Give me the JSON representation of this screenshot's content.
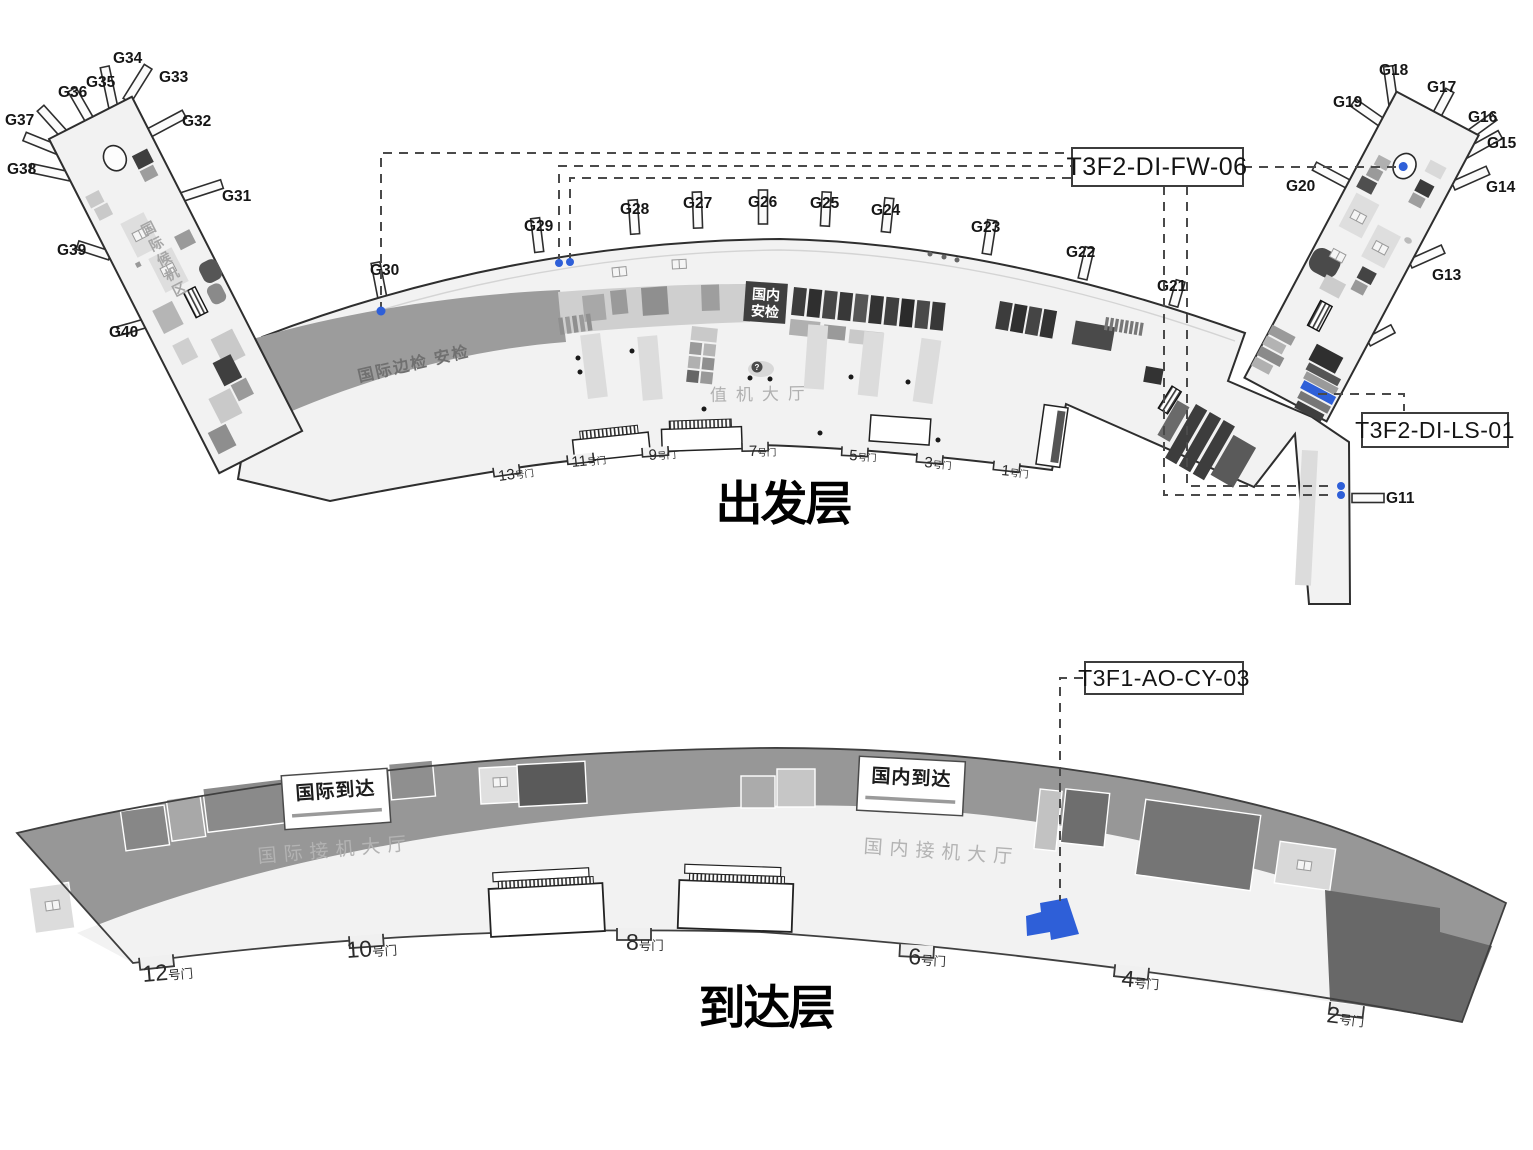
{
  "colors": {
    "highlight": "#2e5fd8",
    "dashed": "#4a4a4a"
  },
  "departure": {
    "title": "出发层",
    "annotations": {
      "fw": "T3F2-DI-FW-06",
      "ls": "T3F2-DI-LS-01"
    },
    "areas": {
      "intl_waiting": "国际候机区",
      "intl_border_security": "国际边检 安检",
      "domestic_security_l1": "国内",
      "domestic_security_l2": "安检",
      "checkin_hall": "值机大厅",
      "info_mark": "?"
    },
    "gates": {
      "g11": "G11",
      "g13": "G13",
      "g14": "G14",
      "g15": "G15",
      "g16": "G16",
      "g17": "G17",
      "g18": "G18",
      "g19": "G19",
      "g20": "G20",
      "g21": "G21",
      "g22": "G22",
      "g23": "G23",
      "g24": "G24",
      "g25": "G25",
      "g26": "G26",
      "g27": "G27",
      "g28": "G28",
      "g29": "G29",
      "g30": "G30",
      "g31": "G31",
      "g32": "G32",
      "g33": "G33",
      "g34": "G34",
      "g35": "G35",
      "g36": "G36",
      "g37": "G37",
      "g38": "G38",
      "g39": "G39",
      "g40": "G40"
    },
    "doors": {
      "d1": {
        "num": "1",
        "suffix": "号门"
      },
      "d3": {
        "num": "3",
        "suffix": "号门"
      },
      "d5": {
        "num": "5",
        "suffix": "号门"
      },
      "d7": {
        "num": "7",
        "suffix": "号门"
      },
      "d9": {
        "num": "9",
        "suffix": "号门"
      },
      "d11": {
        "num": "11",
        "suffix": "号门"
      },
      "d13": {
        "num": "13",
        "suffix": "号门"
      }
    }
  },
  "arrival": {
    "title": "到达层",
    "annotations": {
      "cy": "T3F1-AO-CY-03"
    },
    "signs": {
      "international": "国际到达",
      "domestic": "国内到达"
    },
    "areas": {
      "intl_hall": "国际接机大厅",
      "domestic_hall": "国内接机大厅"
    },
    "doors": {
      "d2": {
        "num": "2",
        "suffix": "号门"
      },
      "d4": {
        "num": "4",
        "suffix": "号门"
      },
      "d6": {
        "num": "6",
        "suffix": "号门"
      },
      "d8": {
        "num": "8",
        "suffix": "号门"
      },
      "d10": {
        "num": "10",
        "suffix": "号门"
      },
      "d12": {
        "num": "12",
        "suffix": "号门"
      }
    }
  }
}
